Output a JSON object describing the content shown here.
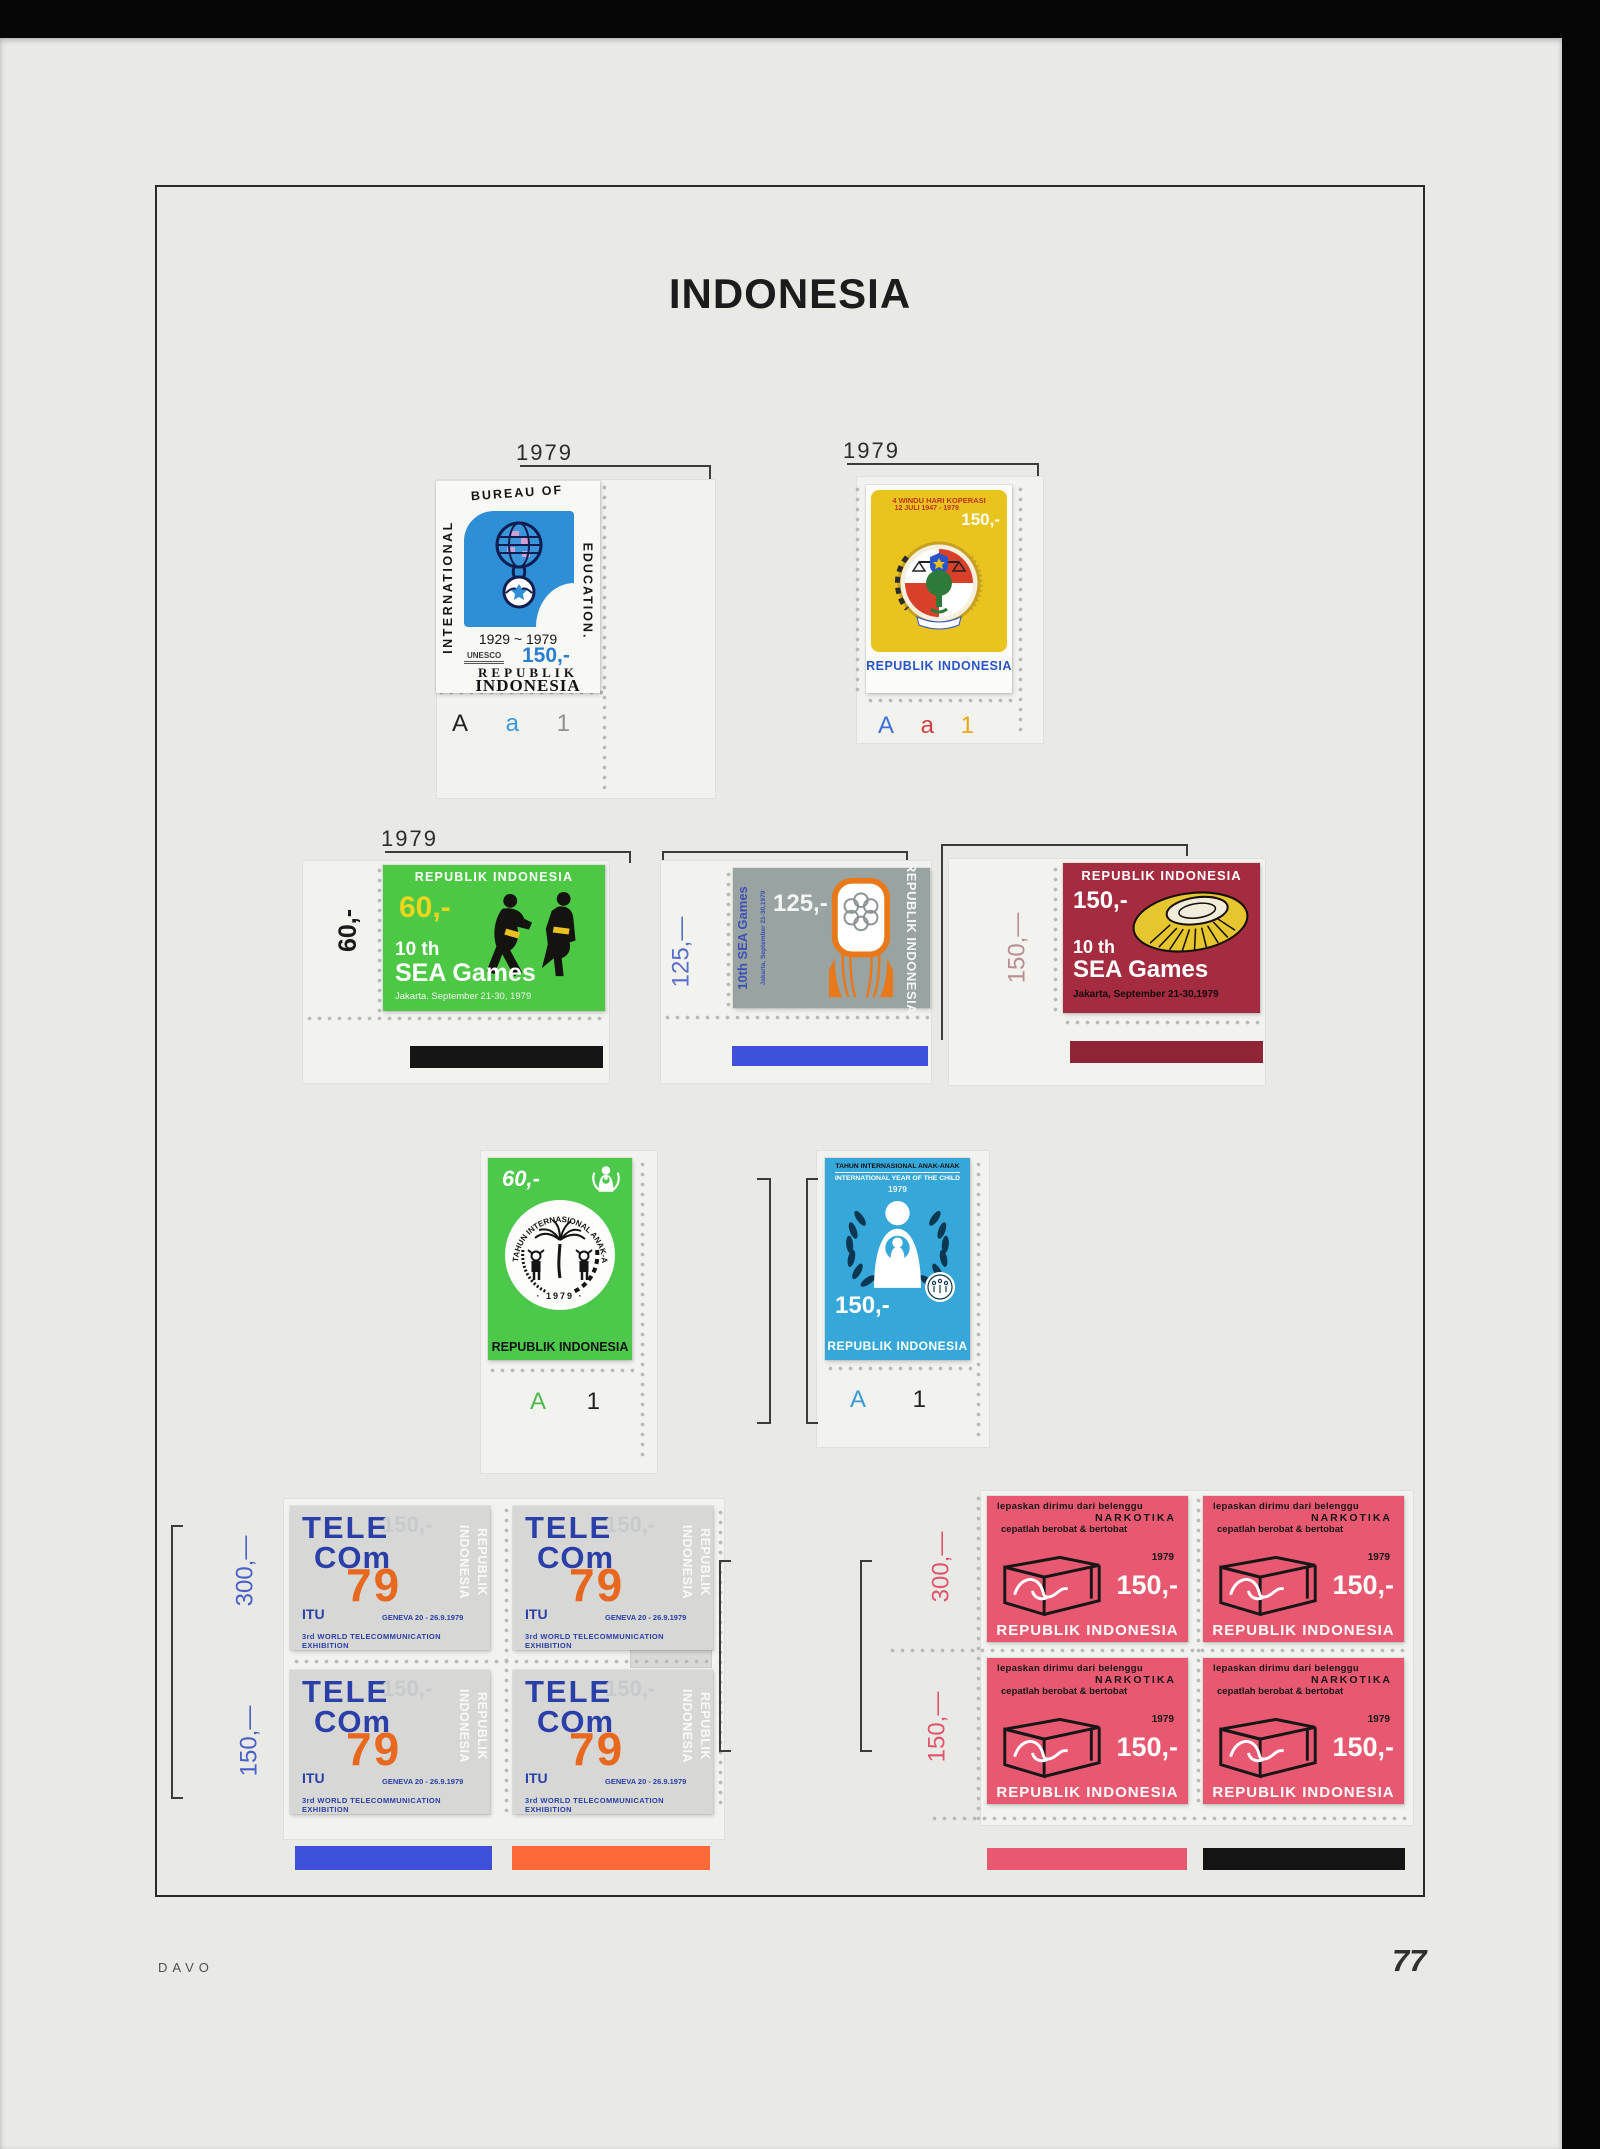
{
  "page": {
    "title": "INDONESIA",
    "page_number": "77",
    "publisher": "DAVO"
  },
  "colors": {
    "paper": "#e9e9e6",
    "frame": "#2b2b2b",
    "bar_black": "#151515",
    "bar_blue": "#3f51d8",
    "bar_dark_red": "#8e2435",
    "bar_orange": "#ff6838",
    "bar_pink": "#e85870",
    "edu_blue": "#2f8fd6",
    "koperasi_yellow": "#e9c41e",
    "sea60_green": "#4cc845",
    "sea125_gray": "#99a3a1",
    "sea150_crimson": "#a52c40",
    "child150_blue": "#35a7d9",
    "telecom_gray": "#d7d7d5",
    "narkotika_pink": "#e85870"
  },
  "education": {
    "year": "1979",
    "plate": [
      "A",
      "a",
      "1"
    ],
    "stamp": {
      "word_left": "INTERNATIONAL",
      "word_top": "BUREAU OF",
      "word_right": "EDUCATION.",
      "years": "1929 ~ 1979",
      "unesco": "UNESCO",
      "value": "150,-",
      "country_line1": "REPUBLIK",
      "country_line2": "INDONESIA"
    }
  },
  "koperasi": {
    "year": "1979",
    "plate": [
      "A",
      "a",
      "1"
    ],
    "stamp": {
      "title_line1": "4 WINDU HARI KOPERASI",
      "title_line2": "12 JULI 1947 - 1979",
      "value": "150,-",
      "country": "REPUBLIK INDONESIA"
    }
  },
  "sea_games": {
    "year": "1979",
    "s60": {
      "margin_label": "60,-",
      "country": "REPUBLIK INDONESIA",
      "value": "60,-",
      "title": "10 th",
      "title2": "SEA Games",
      "subtitle": "Jakarta. September 21-30, 1979"
    },
    "s125": {
      "margin_label": "125,—",
      "side_title": "10th SEA Games",
      "side_subtitle": "Jakarta, September 21-30,1979",
      "value": "125,-",
      "country": "REPUBLIK INDONESIA"
    },
    "s150": {
      "margin_label": "150,—",
      "country": "REPUBLIK INDONESIA",
      "value": "150,-",
      "title": "10 th",
      "title2": "SEA Games",
      "subtitle": "Jakarta, September 21-30,1979"
    }
  },
  "child": {
    "c60": {
      "value": "60,-",
      "ring_text": "TAHUN INTERNASIONAL ANAK-ANAK",
      "ring_year": "· 1979 ·",
      "country": "REPUBLIK INDONESIA",
      "plate": [
        "A",
        "1"
      ]
    },
    "c150": {
      "line1": "TAHUN INTERNASIONAL ANAK-ANAK",
      "line2": "INTERNATIONAL YEAR OF THE CHILD",
      "line3": "1979",
      "value": "150,-",
      "country": "REPUBLIK INDONESIA",
      "plate": [
        "A",
        "1"
      ]
    }
  },
  "telecom": {
    "margin_label_top": "300,—",
    "margin_label_bottom": "150,—",
    "stamp": {
      "logo1": "TELE",
      "logo2": "COm",
      "value": "150,-",
      "country1": "REPUBLIK",
      "country2": "INDONESIA",
      "year_big": "79",
      "itu": "ITU",
      "geneva": "GENEVA 20 - 26.9.1979",
      "exhibition": "3rd WORLD TELECOMMUNICATION EXHIBITION"
    }
  },
  "narkotika": {
    "margin_label_top": "300,—",
    "margin_label_bottom": "150,—",
    "stamp": {
      "line1": "lepaskan dirimu dari belenggu",
      "line2": "NARKOTIKA",
      "line3": "cepatlah berobat & bertobat",
      "year": "1979",
      "value": "150,-",
      "country": "REPUBLIK INDONESIA"
    }
  }
}
